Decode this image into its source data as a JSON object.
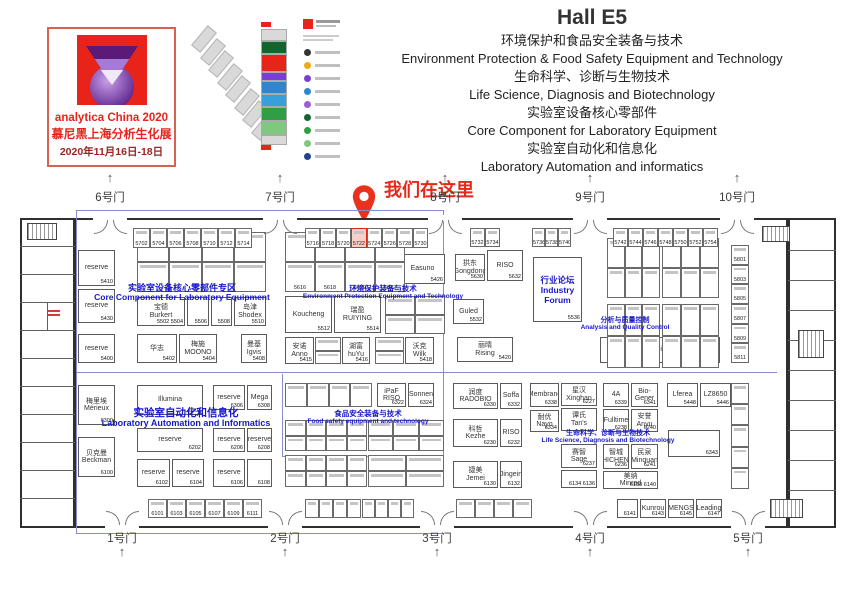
{
  "colors": {
    "accent_red": "#e8231a",
    "zone_blue": "#1717cc",
    "wall": "#2f2f2f",
    "marker_red": "#e82718"
  },
  "header": {
    "logo": {
      "line1": "analytica China 2020",
      "line2": "慕尼黑上海分析生化展",
      "line3": "2020年11月16日-18日"
    },
    "hall_title": "Hall E5",
    "themes": [
      "环境保护和食品安全装备与技术",
      "Environment Protection & Food Safety Equipment and Technology",
      "生命科学、诊断与生物技术",
      "Life Science, Diagnosis and Biotechnology",
      "实验室设备核心零部件",
      "Core Component for Laboratory Equipment",
      "实验室自动化和信息化",
      "Laboratory Automation and informatics"
    ]
  },
  "marker": {
    "text": "我们在这里"
  },
  "minimap": {
    "diag_count": 8,
    "stack": [
      [
        "#d9d9d9",
        10
      ],
      [
        "#11662e",
        11
      ],
      [
        "#e8231a",
        16
      ],
      [
        "#7a3fd0",
        7
      ],
      [
        "#2e86d0",
        11
      ],
      [
        "#36a0d8",
        11
      ],
      [
        "#2f9e44",
        12
      ],
      [
        "#7fc97f",
        12
      ],
      [
        "#d9d9d9",
        8
      ]
    ],
    "legend_dots": [
      "#333333",
      "#f0a818",
      "#7a3fd0",
      "#2e86d0",
      "#9c5fd0",
      "#11662e",
      "#2f9e44",
      "#7fc97f",
      "#24408e"
    ]
  },
  "plan": {
    "gates": {
      "top": [
        {
          "label": "6号门",
          "x": 110
        },
        {
          "label": "7号门",
          "x": 280
        },
        {
          "label": "8号门",
          "x": 445
        },
        {
          "label": "9号门",
          "x": 590
        },
        {
          "label": "10号门",
          "x": 737
        }
      ],
      "bottom": [
        {
          "label": "1号门",
          "x": 122
        },
        {
          "label": "2号门",
          "x": 285
        },
        {
          "label": "3号门",
          "x": 437
        },
        {
          "label": "4号门",
          "x": 590
        },
        {
          "label": "5号门",
          "x": 748
        }
      ]
    },
    "zones": [
      {
        "cx": 182,
        "y": 281,
        "s1": 9,
        "s2": 8.5,
        "l1": "实验室设备核心零部件专区",
        "l2": "Core Component for Laboratory Equipment"
      },
      {
        "cx": 383,
        "y": 283,
        "s1": 7.5,
        "s2": 6.5,
        "l1": "环境保护装备与技术",
        "l2": "Environment Protection Equipment and Technology"
      },
      {
        "cx": 625,
        "y": 315,
        "s1": 7,
        "s2": 6.5,
        "l1": "分析与质量控制",
        "l2": "Analysis and Quality Control"
      },
      {
        "cx": 186,
        "y": 405,
        "s1": 10.5,
        "s2": 9,
        "l1": "实验室自动化和信息化",
        "l2": "Laboratory Automation and Informatics"
      },
      {
        "cx": 368,
        "y": 408,
        "s1": 7.5,
        "s2": 6.5,
        "l1": "食品安全装备与技术",
        "l2": "Food safety equipment and technology"
      },
      {
        "cx": 608,
        "y": 428,
        "s1": 7,
        "s2": 6.5,
        "l1": "生命科学、诊断与生物技术",
        "l2": "Life Science, Diagnosis and Biotechnology"
      }
    ],
    "walls": [
      [
        75,
        218,
        713,
        310
      ],
      [
        20,
        218,
        55,
        310
      ],
      [
        788,
        218,
        48,
        310
      ]
    ],
    "thin_walls": [
      [
        20,
        246,
        55,
        1
      ],
      [
        20,
        274,
        55,
        1
      ],
      [
        20,
        302,
        55,
        1
      ],
      [
        20,
        330,
        55,
        1
      ],
      [
        20,
        358,
        55,
        1
      ],
      [
        20,
        386,
        55,
        1
      ],
      [
        20,
        414,
        55,
        1
      ],
      [
        20,
        442,
        55,
        1
      ],
      [
        20,
        470,
        55,
        1
      ],
      [
        20,
        498,
        55,
        1
      ],
      [
        47,
        302,
        1,
        28
      ],
      [
        788,
        250,
        48,
        1
      ],
      [
        788,
        280,
        48,
        1
      ],
      [
        788,
        310,
        48,
        1
      ],
      [
        788,
        340,
        48,
        1
      ],
      [
        788,
        370,
        48,
        1
      ],
      [
        788,
        400,
        48,
        1
      ],
      [
        788,
        430,
        48,
        1
      ],
      [
        788,
        460,
        48,
        1
      ],
      [
        788,
        490,
        48,
        1
      ]
    ],
    "blue_lines": [
      [
        76,
        210,
        1,
        323
      ],
      [
        443,
        210,
        1,
        246
      ],
      [
        76,
        210,
        368,
        1
      ],
      [
        76,
        372,
        701,
        1
      ],
      [
        76,
        533,
        368,
        1
      ],
      [
        282,
        374,
        1,
        82
      ],
      [
        282,
        456,
        162,
        1
      ]
    ],
    "stairs": [
      [
        27,
        223,
        30,
        17
      ],
      [
        762,
        226,
        28,
        16
      ],
      [
        798,
        330,
        26,
        28
      ],
      [
        770,
        499,
        33,
        19
      ]
    ],
    "red_notes": [
      [
        48,
        310,
        12,
        2
      ],
      [
        48,
        314,
        12,
        2
      ]
    ],
    "booths": [
      {
        "x": 78,
        "y": 250,
        "w": 37,
        "h": 36,
        "n": "reserve",
        "num": "5410"
      },
      {
        "x": 78,
        "y": 289,
        "w": 37,
        "h": 34,
        "n": "reserve",
        "num": "5430"
      },
      {
        "x": 78,
        "y": 334,
        "w": 37,
        "h": 29,
        "n": "reserve",
        "num": "5400"
      },
      {
        "x": 137,
        "y": 297,
        "w": 48,
        "h": 29,
        "n": "宝德\nBurkert",
        "num": "5502 5504"
      },
      {
        "x": 187,
        "y": 297,
        "w": 22,
        "h": 29,
        "n": "",
        "num": "5506"
      },
      {
        "x": 211,
        "y": 297,
        "w": 21,
        "h": 29,
        "n": "",
        "num": "5508"
      },
      {
        "x": 234,
        "y": 297,
        "w": 32,
        "h": 29,
        "n": "岛津\nShodex",
        "num": "5510"
      },
      {
        "x": 137,
        "y": 334,
        "w": 40,
        "h": 29,
        "n": "华志",
        "num": "5402"
      },
      {
        "x": 179,
        "y": 334,
        "w": 38,
        "h": 29,
        "n": "梅施\nMOONO",
        "num": "5404"
      },
      {
        "x": 241,
        "y": 334,
        "w": 26,
        "h": 29,
        "n": "曼基\nIgvis",
        "num": "5408"
      },
      {
        "x": 377,
        "y": 254,
        "w": 21,
        "h": 30,
        "n": "安杰\nAnjie",
        "num": "5424"
      },
      {
        "x": 400,
        "y": 254,
        "w": 45,
        "h": 30,
        "n": "Easuno",
        "num": "5426"
      },
      {
        "x": 285,
        "y": 296,
        "w": 47,
        "h": 37,
        "n": "Koucheng",
        "num": "5512"
      },
      {
        "x": 334,
        "y": 296,
        "w": 47,
        "h": 37,
        "n": "瑞盈\nRUIYING",
        "num": "5514"
      },
      {
        "x": 285,
        "y": 337,
        "w": 29,
        "h": 27,
        "n": "安诺\nAnno",
        "num": "5415"
      },
      {
        "x": 342,
        "y": 337,
        "w": 28,
        "h": 27,
        "n": "湖富\nhuYu",
        "num": "5416"
      },
      {
        "x": 405,
        "y": 337,
        "w": 29,
        "h": 27,
        "n": "沃克\nWilk",
        "num": "5418"
      },
      {
        "x": 377,
        "y": 383,
        "w": 29,
        "h": 24,
        "n": "iPaF\nRISO",
        "num": "6322"
      },
      {
        "x": 408,
        "y": 383,
        "w": 26,
        "h": 24,
        "n": "Sonnen",
        "num": "6324"
      },
      {
        "x": 455,
        "y": 254,
        "w": 30,
        "h": 27,
        "n": "拱东\nGongdong",
        "num": "5630"
      },
      {
        "x": 487,
        "y": 250,
        "w": 36,
        "h": 31,
        "n": "RISO",
        "num": "5632"
      },
      {
        "x": 453,
        "y": 299,
        "w": 31,
        "h": 25,
        "n": "Guled",
        "num": "5532"
      },
      {
        "x": 457,
        "y": 337,
        "w": 56,
        "h": 25,
        "n": "丽晴\nRising",
        "num": "5420"
      },
      {
        "x": 533,
        "y": 257,
        "w": 49,
        "h": 65,
        "n": "行业论坛\nIndustry Forum",
        "num": "5536",
        "cls": "blue"
      },
      {
        "x": 600,
        "y": 337,
        "w": 44,
        "h": 26,
        "n": "reserve",
        "num": "5438"
      },
      {
        "x": 646,
        "y": 337,
        "w": 33,
        "h": 26,
        "n": "Cilro",
        "num": "5442"
      },
      {
        "x": 681,
        "y": 337,
        "w": 39,
        "h": 26,
        "n": "Grinder",
        "num": "5444"
      },
      {
        "x": 453,
        "y": 383,
        "w": 45,
        "h": 26,
        "n": "润度\nRADOBIO",
        "num": "6330"
      },
      {
        "x": 500,
        "y": 383,
        "w": 22,
        "h": 26,
        "n": "Soffa",
        "num": "6332"
      },
      {
        "x": 453,
        "y": 419,
        "w": 45,
        "h": 28,
        "n": "科哲\nKezhe",
        "num": "6230"
      },
      {
        "x": 500,
        "y": 419,
        "w": 22,
        "h": 28,
        "n": "RISO",
        "num": "6232"
      },
      {
        "x": 453,
        "y": 461,
        "w": 45,
        "h": 27,
        "n": "捷美\nJemei",
        "num": "6130"
      },
      {
        "x": 500,
        "y": 461,
        "w": 22,
        "h": 27,
        "n": "Jingein",
        "num": "6132"
      },
      {
        "x": 530,
        "y": 383,
        "w": 29,
        "h": 24,
        "n": "Membrane",
        "num": "6338"
      },
      {
        "x": 530,
        "y": 410,
        "w": 29,
        "h": 22,
        "n": "耐优\nNayo",
        "num": "6334"
      },
      {
        "x": 561,
        "y": 383,
        "w": 36,
        "h": 23,
        "n": "星汉\nXinghan",
        "num": "6227"
      },
      {
        "x": 561,
        "y": 408,
        "w": 36,
        "h": 23,
        "n": "谭氏\nTan's",
        "num": ""
      },
      {
        "x": 561,
        "y": 444,
        "w": 36,
        "h": 24,
        "n": "赛智\nSage",
        "num": "6237"
      },
      {
        "x": 561,
        "y": 470,
        "w": 36,
        "h": 18,
        "n": "",
        "num": "6134 6136"
      },
      {
        "x": 603,
        "y": 383,
        "w": 26,
        "h": 24,
        "n": "4A",
        "num": "6339"
      },
      {
        "x": 631,
        "y": 383,
        "w": 27,
        "h": 24,
        "n": "Bio-Gener",
        "num": "6341"
      },
      {
        "x": 603,
        "y": 409,
        "w": 26,
        "h": 23,
        "n": "Fulltime",
        "num": "6238"
      },
      {
        "x": 631,
        "y": 409,
        "w": 27,
        "h": 23,
        "n": "安誉\nAnyu",
        "num": "6240"
      },
      {
        "x": 603,
        "y": 444,
        "w": 26,
        "h": 25,
        "n": "智城\nZHICHENG",
        "num": "6236"
      },
      {
        "x": 631,
        "y": 444,
        "w": 27,
        "h": 25,
        "n": "民泉\nMinquan",
        "num": "6241"
      },
      {
        "x": 603,
        "y": 471,
        "w": 55,
        "h": 18,
        "n": "美纳\nMinrad",
        "num": "6138 6140"
      },
      {
        "x": 667,
        "y": 383,
        "w": 31,
        "h": 24,
        "n": "Lferea",
        "num": "5448"
      },
      {
        "x": 700,
        "y": 383,
        "w": 31,
        "h": 24,
        "n": "LZ8650",
        "num": "5446"
      },
      {
        "x": 668,
        "y": 430,
        "w": 52,
        "h": 27,
        "n": "",
        "num": "6343"
      },
      {
        "x": 617,
        "y": 499,
        "w": 21,
        "h": 19,
        "n": "",
        "num": "6141"
      },
      {
        "x": 640,
        "y": 499,
        "w": 26,
        "h": 19,
        "n": "Kunrou",
        "num": "6143"
      },
      {
        "x": 668,
        "y": 499,
        "w": 26,
        "h": 19,
        "n": "MENGS",
        "num": "6145"
      },
      {
        "x": 696,
        "y": 499,
        "w": 26,
        "h": 19,
        "n": "Leading",
        "num": "6147"
      },
      {
        "x": 78,
        "y": 385,
        "w": 37,
        "h": 40,
        "n": "梅里埃\nMérieux",
        "num": "6300"
      },
      {
        "x": 78,
        "y": 437,
        "w": 37,
        "h": 40,
        "n": "贝克曼\nBeckman",
        "num": "6100"
      },
      {
        "x": 137,
        "y": 385,
        "w": 66,
        "h": 30,
        "n": "Illumina",
        "num": "6302"
      },
      {
        "x": 213,
        "y": 385,
        "w": 32,
        "h": 25,
        "n": "reserve",
        "num": "6306"
      },
      {
        "x": 247,
        "y": 385,
        "w": 25,
        "h": 25,
        "n": "Mega",
        "num": "6308"
      },
      {
        "x": 137,
        "y": 428,
        "w": 66,
        "h": 24,
        "n": "reserve",
        "num": "6202"
      },
      {
        "x": 213,
        "y": 428,
        "w": 32,
        "h": 24,
        "n": "reserve",
        "num": "6206"
      },
      {
        "x": 247,
        "y": 428,
        "w": 25,
        "h": 24,
        "n": "reserve",
        "num": "6208"
      },
      {
        "x": 137,
        "y": 459,
        "w": 33,
        "h": 28,
        "n": "reserve",
        "num": "6102"
      },
      {
        "x": 172,
        "y": 459,
        "w": 32,
        "h": 28,
        "n": "reserve",
        "num": "6104"
      },
      {
        "x": 213,
        "y": 459,
        "w": 32,
        "h": 28,
        "n": "reserve",
        "num": "6106"
      },
      {
        "x": 247,
        "y": 459,
        "w": 25,
        "h": 28,
        "n": "",
        "num": "6108"
      }
    ],
    "grids": [
      {
        "x": 137,
        "y": 232,
        "w": 129,
        "h": 60,
        "cols": 4,
        "rows": 2
      },
      {
        "x": 285,
        "y": 232,
        "w": 120,
        "h": 60,
        "cols": 4,
        "rows": 2,
        "nums": [
          "",
          "",
          "",
          "",
          "5616",
          "5618",
          "5620",
          "5622"
        ]
      },
      {
        "x": 385,
        "y": 296,
        "w": 60,
        "h": 38,
        "cols": 2,
        "rows": 2
      },
      {
        "x": 315,
        "y": 337,
        "w": 26,
        "h": 27,
        "cols": 1,
        "rows": 2
      },
      {
        "x": 375,
        "y": 337,
        "w": 29,
        "h": 27,
        "cols": 1,
        "rows": 2
      },
      {
        "x": 607,
        "y": 238,
        "w": 53,
        "h": 60,
        "cols": 3,
        "rows": 2
      },
      {
        "x": 662,
        "y": 238,
        "w": 57,
        "h": 60,
        "cols": 3,
        "rows": 2
      },
      {
        "x": 607,
        "y": 304,
        "w": 53,
        "h": 64,
        "cols": 3,
        "rows": 2
      },
      {
        "x": 662,
        "y": 304,
        "w": 57,
        "h": 64,
        "cols": 3,
        "rows": 2
      },
      {
        "x": 731,
        "y": 245,
        "w": 18,
        "h": 118,
        "cols": 1,
        "rows": 6,
        "nums": [
          "5801",
          "5803",
          "5805",
          "5807",
          "5809",
          "5811"
        ]
      },
      {
        "x": 731,
        "y": 383,
        "w": 18,
        "h": 106,
        "cols": 1,
        "rows": 5
      },
      {
        "x": 285,
        "y": 383,
        "w": 87,
        "h": 24,
        "cols": 4,
        "rows": 1
      },
      {
        "x": 285,
        "y": 420,
        "w": 82,
        "h": 31,
        "cols": 4,
        "rows": 2
      },
      {
        "x": 285,
        "y": 455,
        "w": 82,
        "h": 32,
        "cols": 4,
        "rows": 2
      },
      {
        "x": 368,
        "y": 420,
        "w": 76,
        "h": 31,
        "cols": 3,
        "rows": 2
      },
      {
        "x": 368,
        "y": 455,
        "w": 76,
        "h": 32,
        "cols": 2,
        "rows": 2
      }
    ],
    "strips": [
      {
        "x": 133,
        "y": 228,
        "h": 20,
        "cw": 17,
        "n": 7,
        "nums": [
          "5702",
          "5704",
          "5706",
          "5708",
          "5710",
          "5712",
          "5714"
        ]
      },
      {
        "x": 305,
        "y": 228,
        "h": 20,
        "cw": 15.4,
        "n": 8,
        "hl": 3,
        "nums": [
          "5716",
          "5718",
          "5720",
          "5722",
          "5724",
          "5726",
          "5728",
          "5730"
        ]
      },
      {
        "x": 470,
        "y": 228,
        "h": 19,
        "cw": 15,
        "n": 2,
        "nums": [
          "5732",
          "5734"
        ]
      },
      {
        "x": 532,
        "y": 228,
        "h": 19,
        "cw": 13,
        "n": 3,
        "nums": [
          "5736",
          "5738",
          "5740"
        ]
      },
      {
        "x": 613,
        "y": 228,
        "h": 19,
        "cw": 15,
        "n": 7,
        "nums": [
          "5742",
          "5744",
          "5746",
          "5748",
          "5750",
          "5752",
          "5754"
        ]
      },
      {
        "x": 148,
        "y": 499,
        "h": 19,
        "cw": 19,
        "n": 6,
        "nums": [
          "6101",
          "6103",
          "6105",
          "6107",
          "6109",
          "6111"
        ]
      },
      {
        "x": 305,
        "y": 499,
        "h": 19,
        "cw": 14,
        "n": 4,
        "nums": []
      },
      {
        "x": 362,
        "y": 499,
        "h": 19,
        "cw": 13,
        "n": 4,
        "nums": []
      },
      {
        "x": 456,
        "y": 499,
        "h": 19,
        "cw": 19,
        "n": 4,
        "nums": []
      }
    ]
  }
}
